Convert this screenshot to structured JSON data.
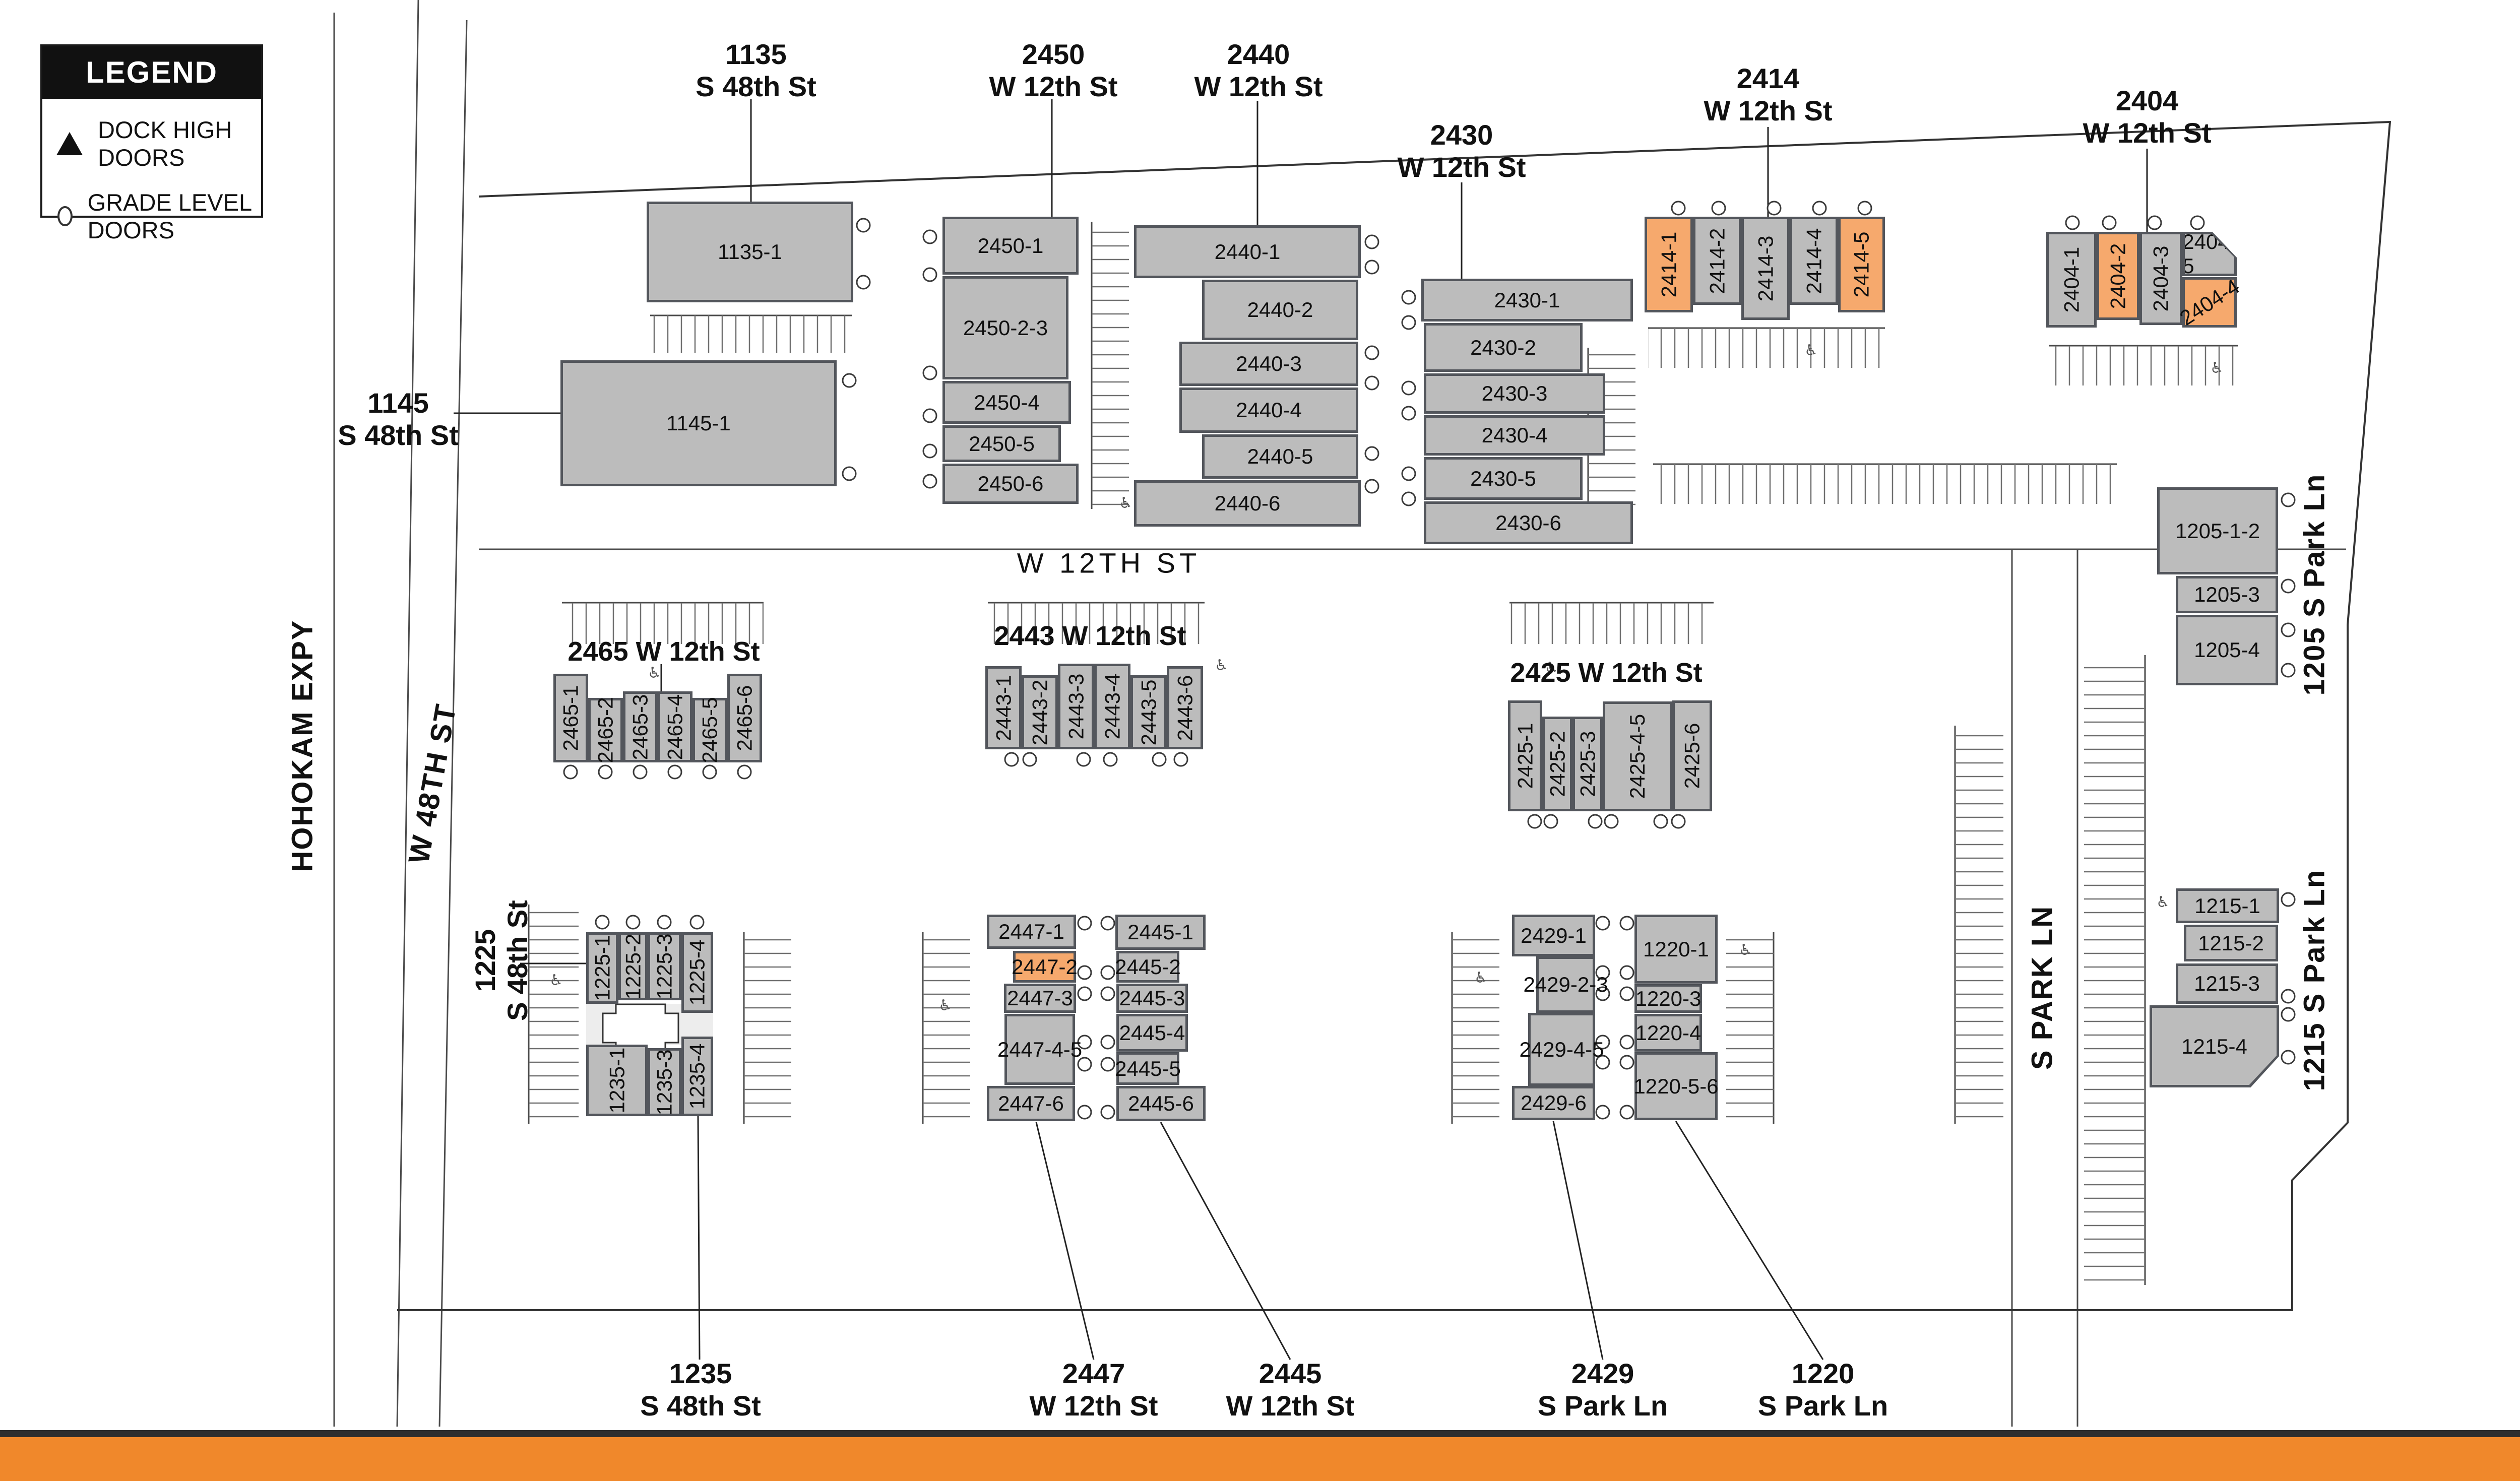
{
  "legend": {
    "title": "LEGEND",
    "items": [
      {
        "symbol": "triangle-icon",
        "label": "DOCK HIGH DOORS"
      },
      {
        "symbol": "circle-icon",
        "label": "GRADE LEVEL DOORS"
      }
    ]
  },
  "north_arrow": {
    "label": "N"
  },
  "streets": {
    "hohokam": "HOHOKAM EXPY",
    "w48th": "W 48TH ST",
    "w12th": "W 12TH ST",
    "s_park": "S PARK LN"
  },
  "colors": {
    "building_gray": "#bcbcbc",
    "building_outline": "#53565c",
    "highlight_orange": "#f6a96d",
    "footer_orange": "#f0882b"
  },
  "groups": {
    "g1135": {
      "address": [
        "1135",
        "S 48th St"
      ],
      "units": [
        "1135-1"
      ]
    },
    "g1145": {
      "address": [
        "1145",
        "S 48th St"
      ],
      "units": [
        "1145-1"
      ]
    },
    "g2450": {
      "address": [
        "2450",
        "W 12th St"
      ],
      "units": [
        "2450-1",
        "2450-2-3",
        "2450-4",
        "2450-5",
        "2450-6"
      ]
    },
    "g2440": {
      "address": [
        "2440",
        "W 12th St"
      ],
      "units": [
        "2440-1",
        "2440-2",
        "2440-3",
        "2440-4",
        "2440-5",
        "2440-6"
      ]
    },
    "g2430": {
      "address": [
        "2430",
        "W 12th St"
      ],
      "units": [
        "2430-1",
        "2430-2",
        "2430-3",
        "2430-4",
        "2430-5",
        "2430-6"
      ]
    },
    "g2414": {
      "address": [
        "2414",
        "W 12th St"
      ],
      "units": [
        "2414-1",
        "2414-2",
        "2414-3",
        "2414-4",
        "2414-5"
      ],
      "highlighted": [
        "2414-1",
        "2414-5"
      ]
    },
    "g2404": {
      "address": [
        "2404",
        "W 12th St"
      ],
      "units": [
        "2404-1",
        "2404-2",
        "2404-3",
        "2404-5",
        "2404-4"
      ],
      "highlighted": [
        "2404-2",
        "2404-4"
      ]
    },
    "g2465": {
      "address_line": "2465 W 12th St",
      "units": [
        "2465-1",
        "2465-2",
        "2465-3",
        "2465-4",
        "2465-5",
        "2465-6"
      ]
    },
    "g2443": {
      "address_line": "2443 W 12th St",
      "units": [
        "2443-1",
        "2443-2",
        "2443-3",
        "2443-4",
        "2443-5",
        "2443-6"
      ]
    },
    "g2425": {
      "address_line": "2425 W 12th St",
      "units": [
        "2425-1",
        "2425-2",
        "2425-3",
        "2425-4-5",
        "2425-6"
      ]
    },
    "g1225": {
      "address": [
        "1225",
        "S 48th St"
      ],
      "units": [
        "1225-1",
        "1225-2",
        "1225-3",
        "1225-4"
      ]
    },
    "g1235": {
      "address": [
        "1235",
        "S 48th St"
      ],
      "units": [
        "1235-1",
        "1235-3",
        "1235-4"
      ]
    },
    "g2447": {
      "address": [
        "2447",
        "W 12th St"
      ],
      "units": [
        "2447-1",
        "2447-2",
        "2447-3",
        "2447-4-5",
        "2447-6"
      ],
      "highlighted": [
        "2447-2"
      ]
    },
    "g2445": {
      "address": [
        "2445",
        "W 12th St"
      ],
      "units": [
        "2445-1",
        "2445-2",
        "2445-3",
        "2445-4",
        "2445-5",
        "2445-6"
      ]
    },
    "g2429": {
      "address": [
        "2429",
        "S Park Ln"
      ],
      "units": [
        "2429-1",
        "2429-2-3",
        "2429-4-5",
        "2429-6"
      ]
    },
    "g1220": {
      "address": [
        "1220",
        "S Park Ln"
      ],
      "units": [
        "1220-1",
        "1220-3",
        "1220-4",
        "1220-5-6"
      ]
    },
    "g1205": {
      "street_label": "1205 S Park Ln",
      "units": [
        "1205-1-2",
        "1205-3",
        "1205-4"
      ]
    },
    "g1215": {
      "street_label": "1215 S Park Ln",
      "units": [
        "1215-1",
        "1215-2",
        "1215-3",
        "1215-4"
      ]
    }
  }
}
